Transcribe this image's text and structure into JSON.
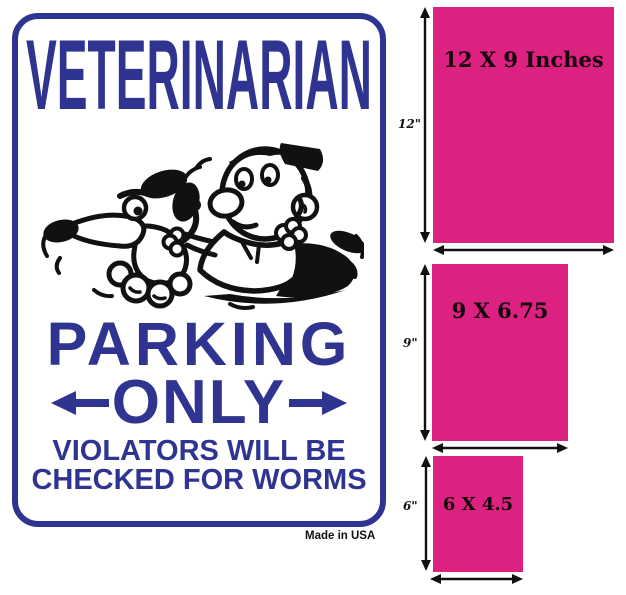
{
  "colors": {
    "sign_blue": "#2f3490",
    "swatch_pink": "#dd2181",
    "ink_black": "#111111"
  },
  "sign": {
    "title": "VETERINARIAN",
    "parking": "PARKING",
    "only": "ONLY",
    "violators_line1": "VIOLATORS WILL BE",
    "violators_line2": "CHECKED FOR WORMS",
    "made_in": "Made in USA",
    "cartoon": "vet-examining-dog-for-worms-cartoon"
  },
  "size_chart": {
    "items": [
      {
        "label": "12 X 9 Inches",
        "height_label": "12\""
      },
      {
        "label": "9 X 6.75",
        "height_label": "9\""
      },
      {
        "label": "6 X 4.5",
        "height_label": "6\""
      }
    ]
  }
}
